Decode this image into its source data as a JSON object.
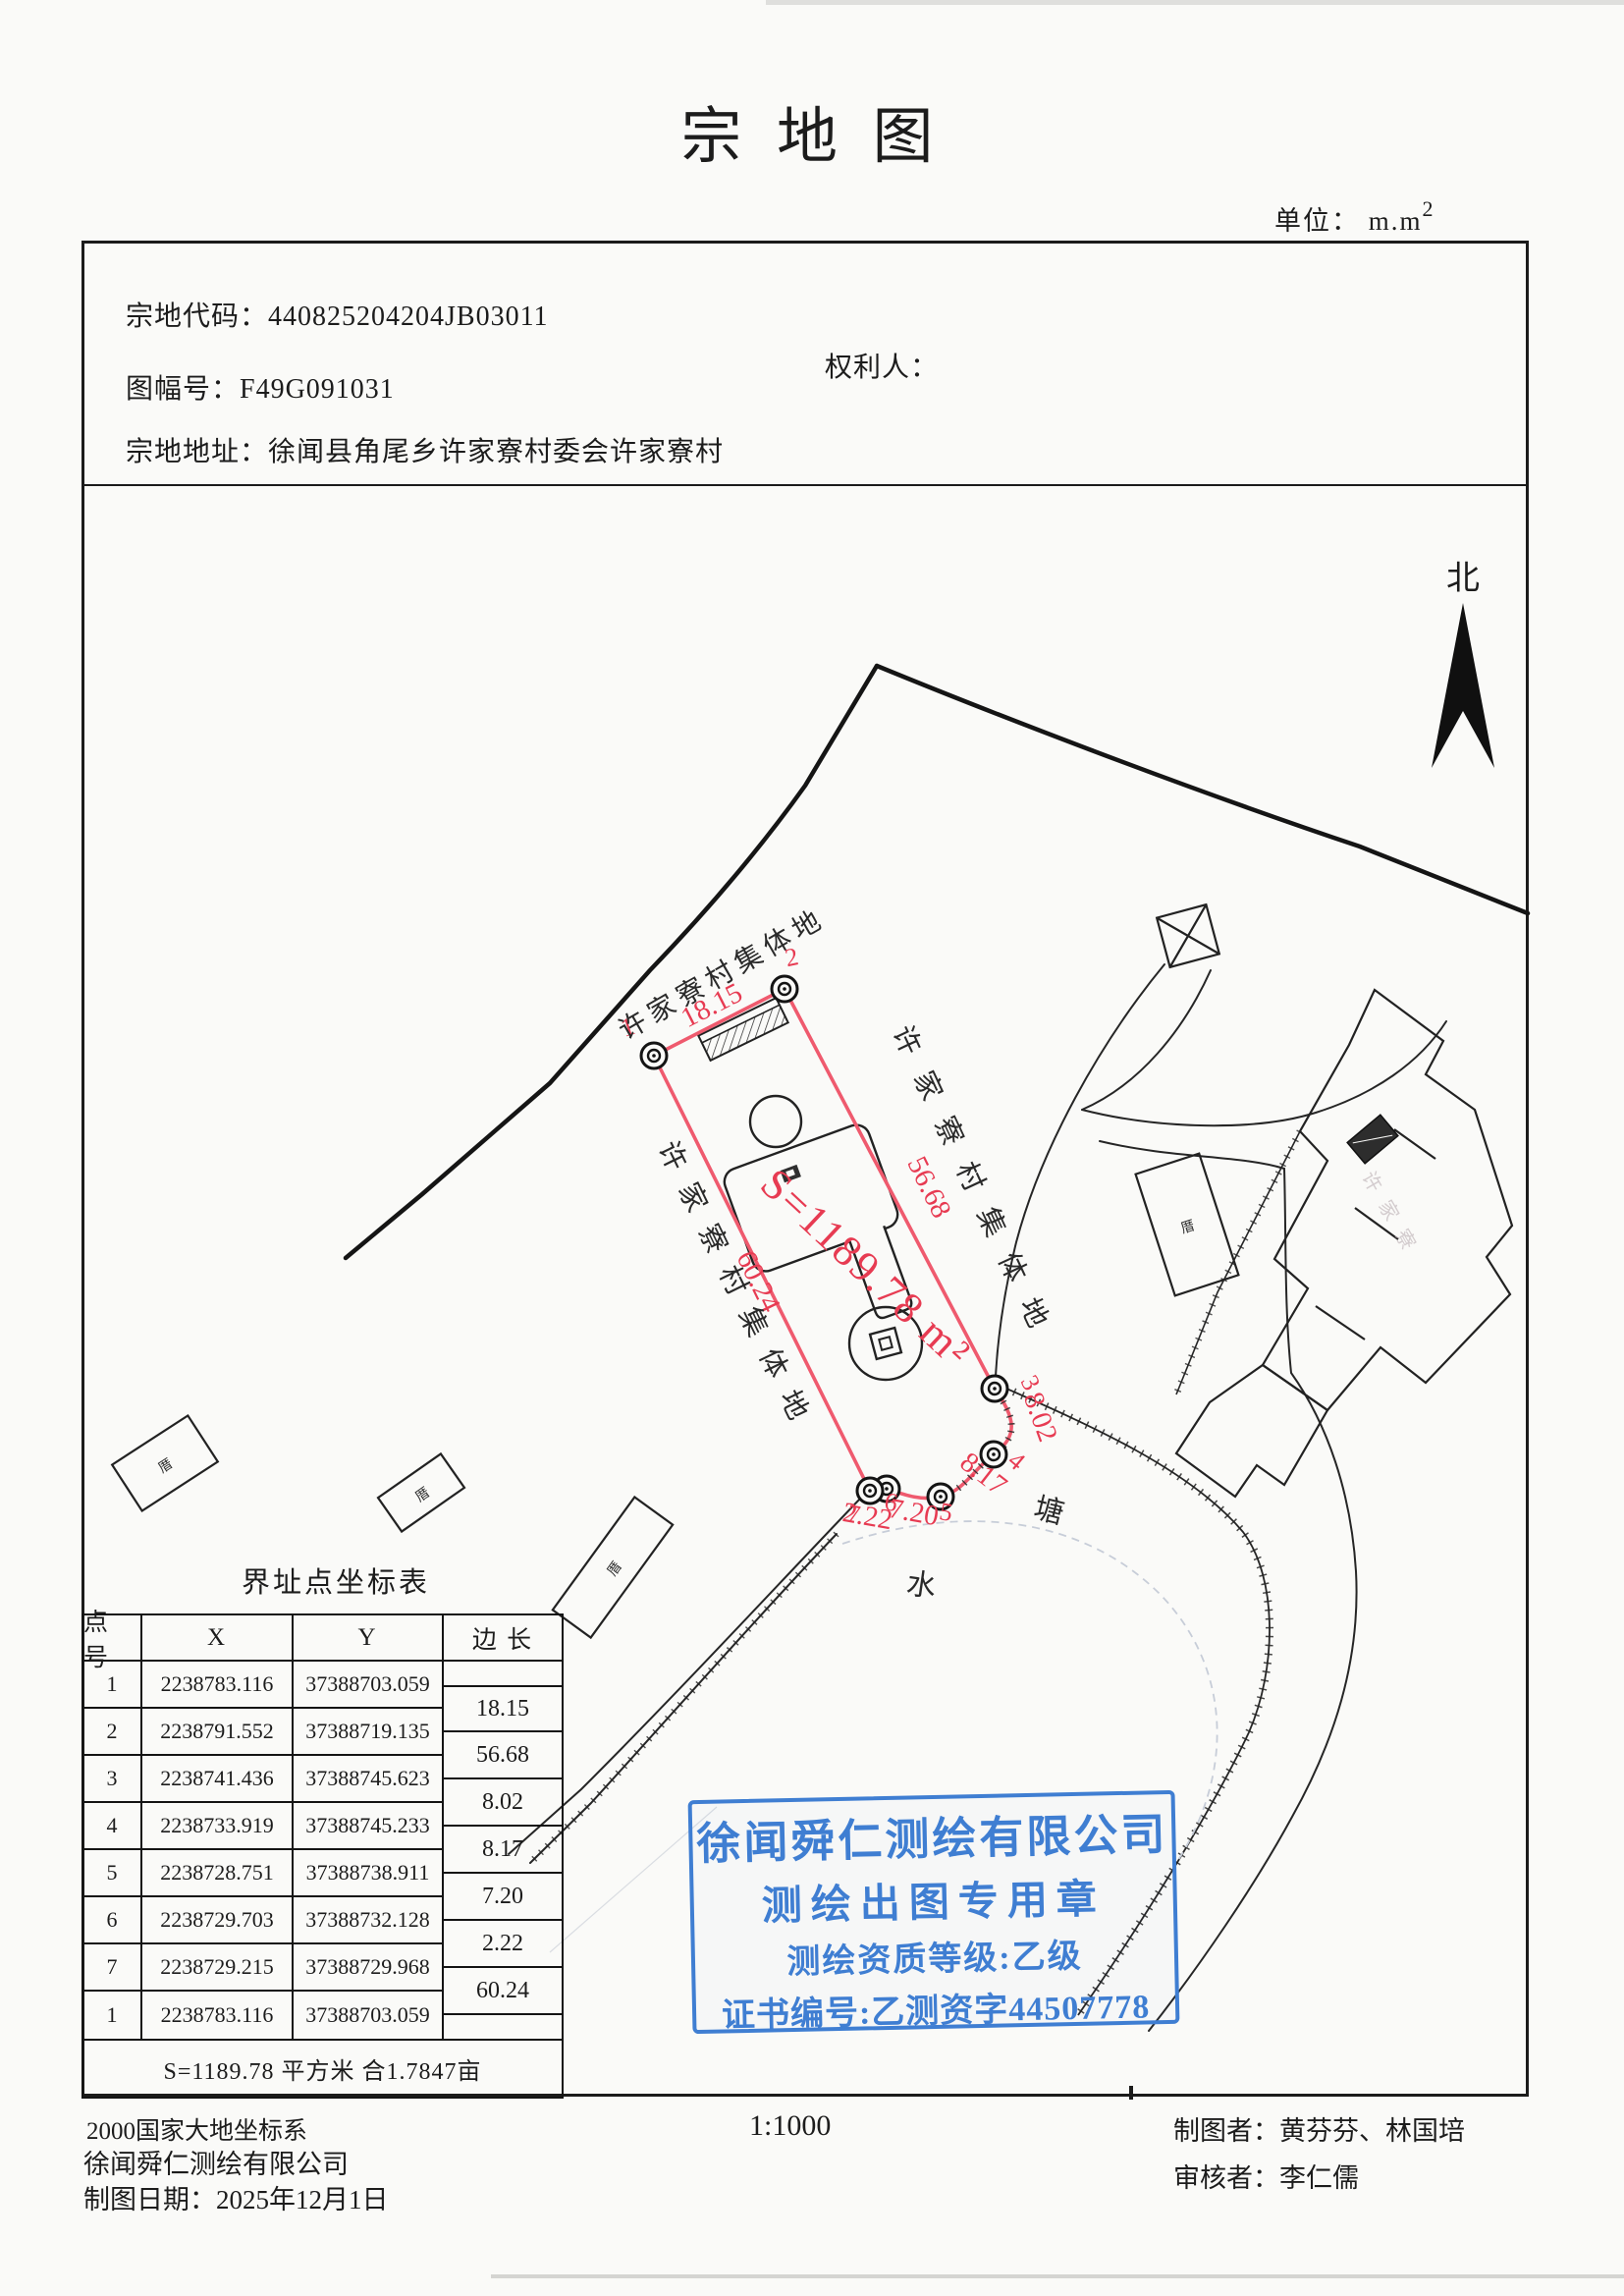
{
  "page": {
    "title": "宗 地 图",
    "unit_label": "单位： m.m",
    "unit_sup": "2"
  },
  "header": {
    "parcel_code_label": "宗地代码：",
    "parcel_code": "440825204204JB03011",
    "sheet_no_label": "图幅号：",
    "sheet_no": "F49G091031",
    "owner_label": "权利人：",
    "owner_value": "",
    "address_label": "宗地地址：",
    "address": "徐闻县角尾乡许家寮村委会许家寮村"
  },
  "compass": {
    "north_label": "北"
  },
  "map": {
    "village_label": "许家寮村集体地",
    "village_label_faint": "许家寮",
    "area_label": "S=1189.78 m²",
    "water_char": "水",
    "pond_char": "塘",
    "house_char": "厝"
  },
  "parcel": {
    "point_labels": [
      "1",
      "2",
      "3",
      "4",
      "5",
      "6",
      "7"
    ],
    "edges": [
      "18.15",
      "56.68",
      "8.02",
      "8.17",
      "7.20",
      "2.22",
      "60.24"
    ]
  },
  "table": {
    "title": "界址点坐标表",
    "headers": [
      "点 号",
      "X",
      "Y",
      "边 长"
    ],
    "rows": [
      {
        "no": "1",
        "x": "2238783.116",
        "y": "37388703.059"
      },
      {
        "no": "2",
        "x": "2238791.552",
        "y": "37388719.135"
      },
      {
        "no": "3",
        "x": "2238741.436",
        "y": "37388745.623"
      },
      {
        "no": "4",
        "x": "2238733.919",
        "y": "37388745.233"
      },
      {
        "no": "5",
        "x": "2238728.751",
        "y": "37388738.911"
      },
      {
        "no": "6",
        "x": "2238729.703",
        "y": "37388732.128"
      },
      {
        "no": "7",
        "x": "2238729.215",
        "y": "37388729.968"
      },
      {
        "no": "1",
        "x": "2238783.116",
        "y": "37388703.059"
      }
    ],
    "summary": "S=1189.78 平方米 合1.7847亩"
  },
  "stamp": {
    "line1": "徐闻舜仁测绘有限公司",
    "line2": "测绘出图专用章",
    "line3": "测绘资质等级:乙级",
    "line4": "证书编号:乙测资字44507778"
  },
  "footer": {
    "crs": "2000国家大地坐标系",
    "company": "徐闻舜仁测绘有限公司",
    "date_label": "制图日期：",
    "date": "2025年12月1日",
    "scale": "1:1000",
    "drafter_label": "制图者：",
    "drafter": "黄芬芬、林国培",
    "reviewer_label": "审核者：",
    "reviewer": "李仁儒"
  },
  "colors": {
    "parcel_red": "#ef5a6e",
    "label_red": "#e73b52",
    "stamp_blue": "#3f7ed2",
    "ink": "#1c1c1c"
  }
}
